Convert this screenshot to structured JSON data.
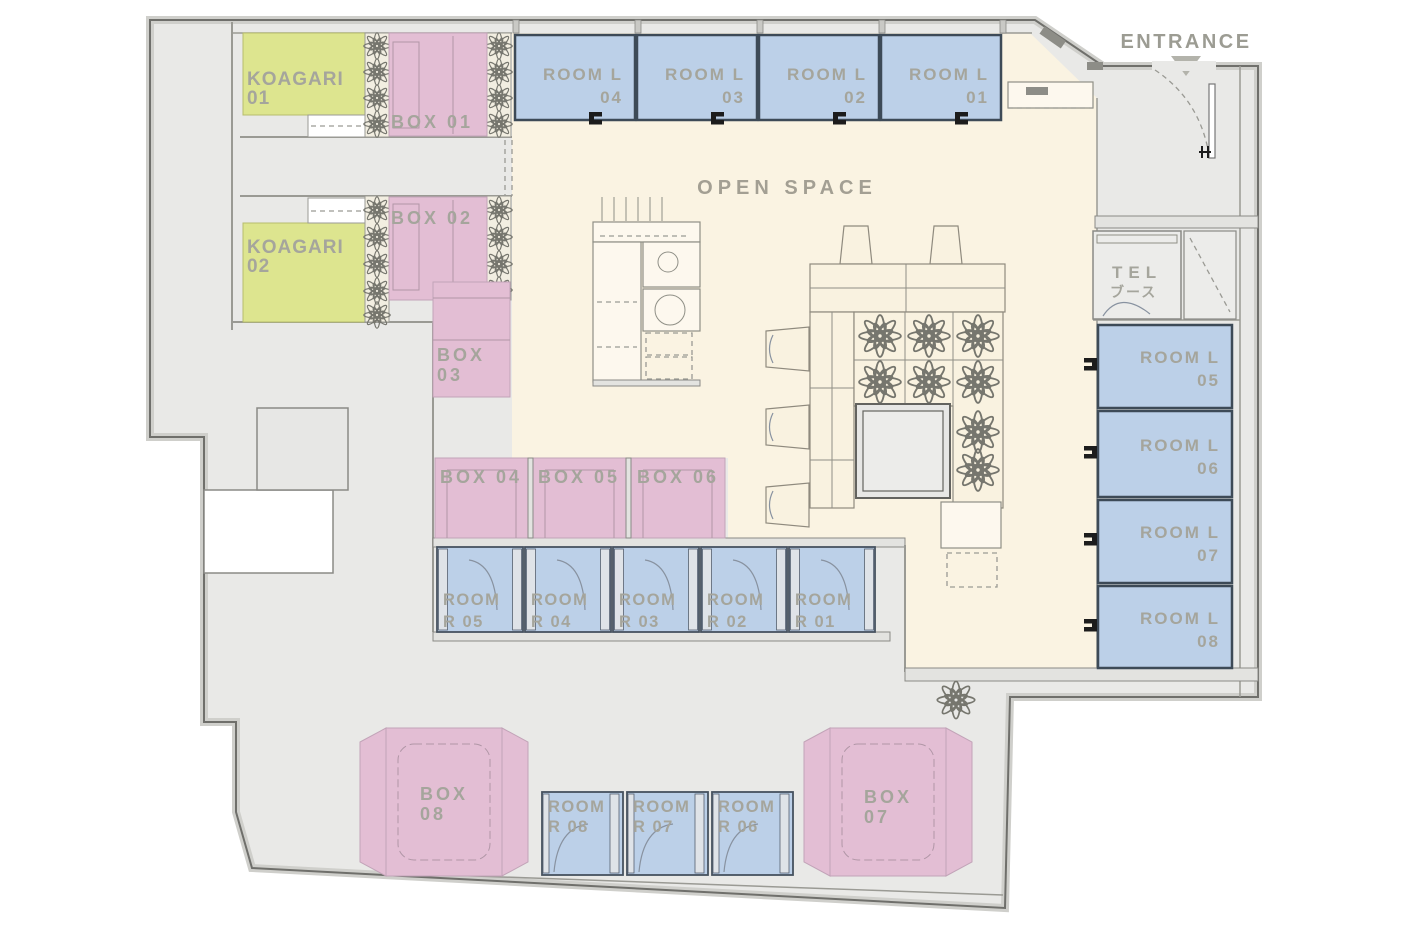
{
  "title": "coworking-floor-plan",
  "entrance": {
    "label": "ENTRANCE"
  },
  "open_space": {
    "label": "OPEN SPACE"
  },
  "tel_booth": {
    "line1": "TEL",
    "line2": "ブース"
  },
  "koagari": [
    {
      "line1": "KOAGARI",
      "line2": "01"
    },
    {
      "line1": "KOAGARI",
      "line2": "02"
    }
  ],
  "box01": {
    "label": "BOX 01"
  },
  "box02": {
    "label": "BOX 02"
  },
  "box03": {
    "line1": "BOX",
    "line2": "03"
  },
  "box_row": [
    {
      "label": "BOX 04"
    },
    {
      "label": "BOX 05"
    },
    {
      "label": "BOX 06"
    }
  ],
  "box_bottom": [
    {
      "line1": "BOX",
      "line2": "08"
    },
    {
      "line1": "BOX",
      "line2": "07"
    }
  ],
  "rooms_l_top": [
    {
      "line1": "ROOM L",
      "line2": "04"
    },
    {
      "line1": "ROOM L",
      "line2": "03"
    },
    {
      "line1": "ROOM L",
      "line2": "02"
    },
    {
      "line1": "ROOM L",
      "line2": "01"
    }
  ],
  "rooms_l_right": [
    {
      "line1": "ROOM L",
      "line2": "05"
    },
    {
      "line1": "ROOM L",
      "line2": "06"
    },
    {
      "line1": "ROOM L",
      "line2": "07"
    },
    {
      "line1": "ROOM L",
      "line2": "08"
    }
  ],
  "rooms_r_top": [
    {
      "line1": "ROOM",
      "line2": "R 05"
    },
    {
      "line1": "ROOM",
      "line2": "R 04"
    },
    {
      "line1": "ROOM",
      "line2": "R 03"
    },
    {
      "line1": "ROOM",
      "line2": "R 02"
    },
    {
      "line1": "ROOM",
      "line2": "R 01"
    }
  ],
  "rooms_r_bottom": [
    {
      "line1": "ROOM",
      "line2": "R 08"
    },
    {
      "line1": "ROOM",
      "line2": "R 07"
    },
    {
      "line1": "ROOM",
      "line2": "R 06"
    }
  ],
  "colors": {
    "floor": "#e9e9e7",
    "open_space": "#faf3e2",
    "room_blue": "#bcd0e8",
    "room_border": "#3d4a57",
    "box_pink": "#e3bed4",
    "koagari_green": "#dde58f",
    "planter_bg": "#f2eee1",
    "wall_dark": "#6f6f6b",
    "label_gray": "#a5a59c",
    "handle_black": "#1c1c1c",
    "entrance_arrow": "#b3b3ab"
  }
}
